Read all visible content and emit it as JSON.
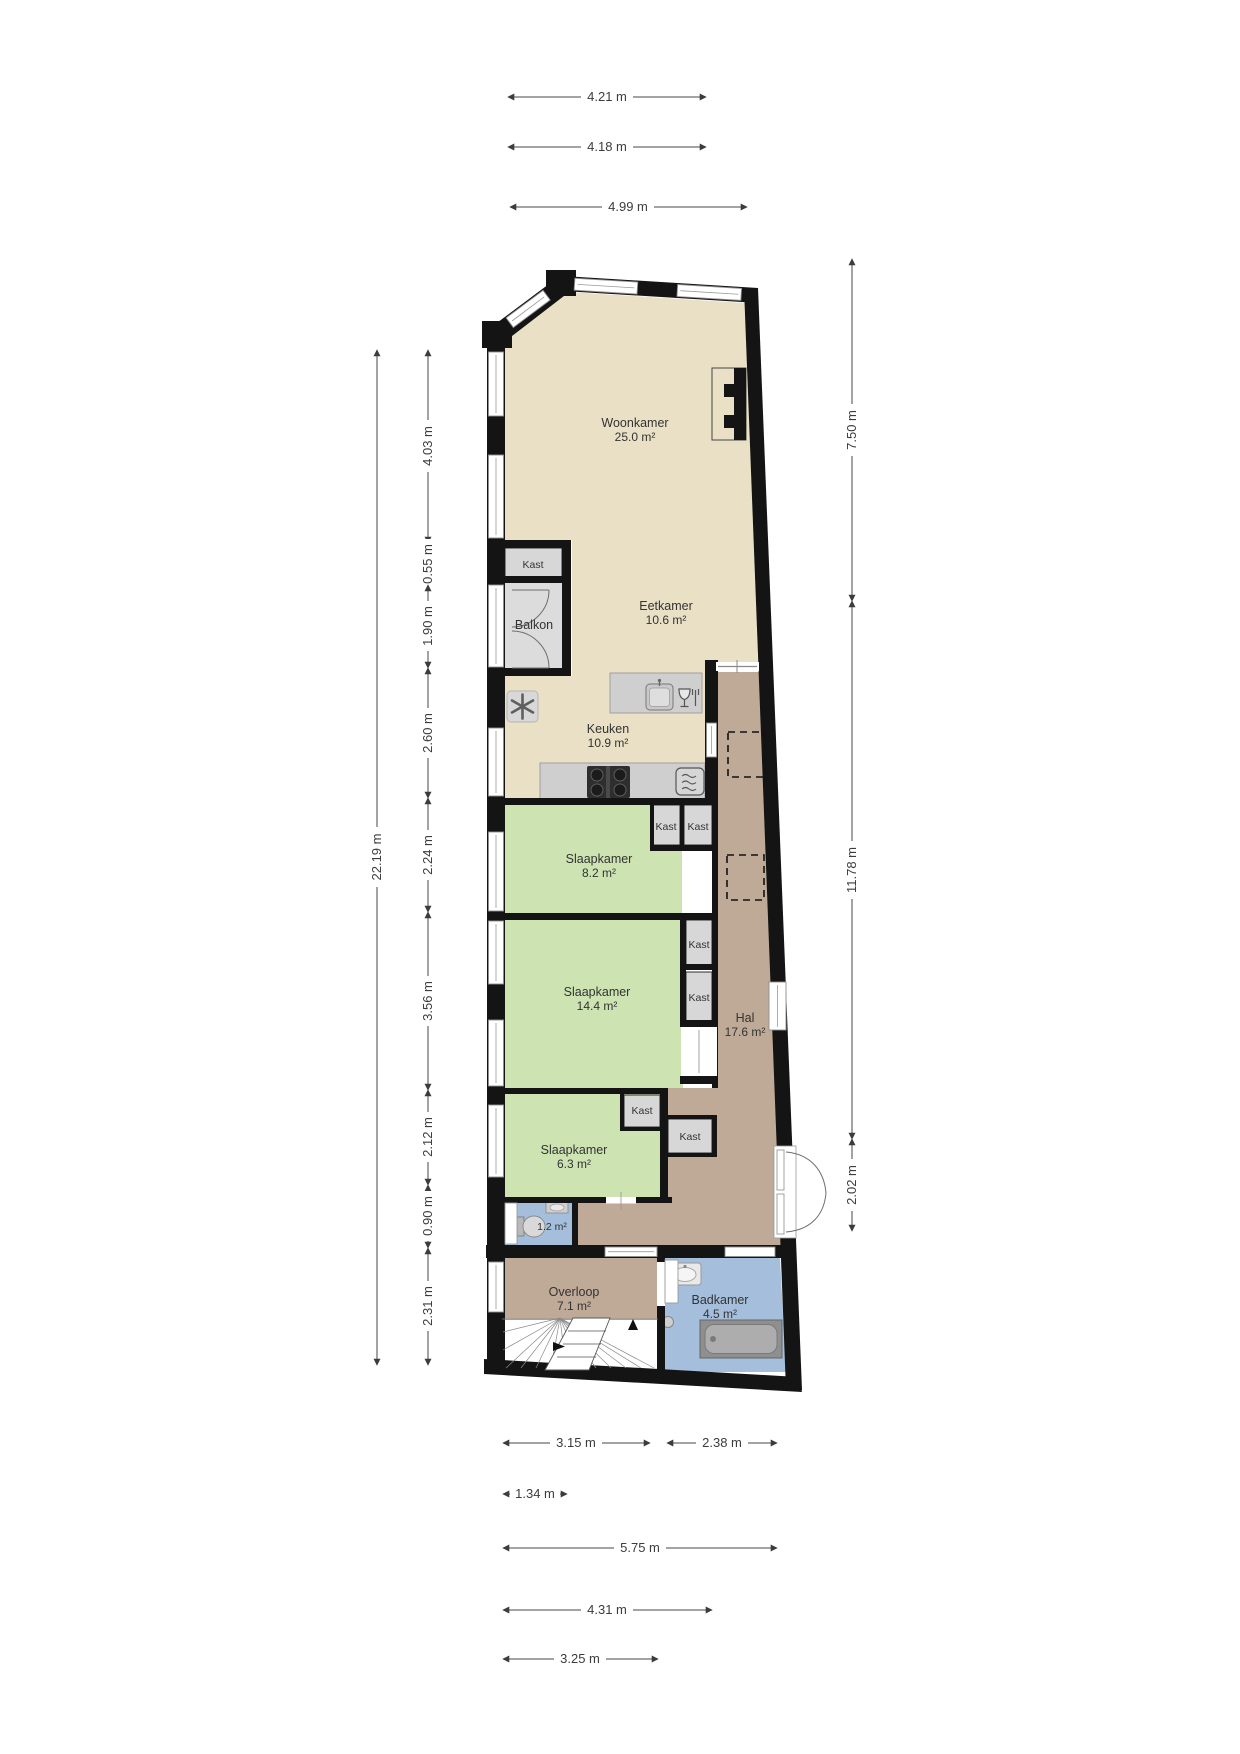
{
  "rooms": {
    "woonkamer": {
      "name": "Woonkamer",
      "area": "25.0 m²"
    },
    "eetkamer": {
      "name": "Eetkamer",
      "area": "10.6 m²"
    },
    "keuken": {
      "name": "Keuken",
      "area": "10.9 m²"
    },
    "balkon": {
      "name": "Balkon"
    },
    "slaapkamer1": {
      "name": "Slaapkamer",
      "area": "8.2 m²"
    },
    "slaapkamer2": {
      "name": "Slaapkamer",
      "area": "14.4 m²"
    },
    "hal": {
      "name": "Hal",
      "area": "17.6 m²"
    },
    "slaapkamer3": {
      "name": "Slaapkamer",
      "area": "6.3 m²"
    },
    "toilet": {
      "area": "1.2 m²"
    },
    "overloop": {
      "name": "Overloop",
      "area": "7.1 m²"
    },
    "badkamer": {
      "name": "Badkamer",
      "area": "4.5 m²"
    }
  },
  "labels": {
    "kast": "Kast"
  },
  "dimensions": {
    "top": [
      "4.21 m",
      "4.18 m",
      "4.99 m"
    ],
    "left_total": "22.19 m",
    "left": [
      "4.03 m",
      "0.55 m",
      "1.90 m",
      "2.60 m",
      "2.24 m",
      "3.56 m",
      "2.12 m",
      "0.90 m",
      "2.31 m"
    ],
    "right": [
      "7.50 m",
      "11.78 m",
      "2.02 m"
    ],
    "bottom": [
      "3.15 m",
      "2.38 m",
      "1.34 m",
      "5.75 m",
      "4.31 m",
      "3.25 m"
    ]
  },
  "colors": {
    "floor_living": "#e9e0c6",
    "floor_bedroom": "#cde3b2",
    "floor_hall": "#bfaa97",
    "floor_bath": "#a4bedb",
    "floor_balcony": "#dcdcdc",
    "wall": "#141414"
  }
}
